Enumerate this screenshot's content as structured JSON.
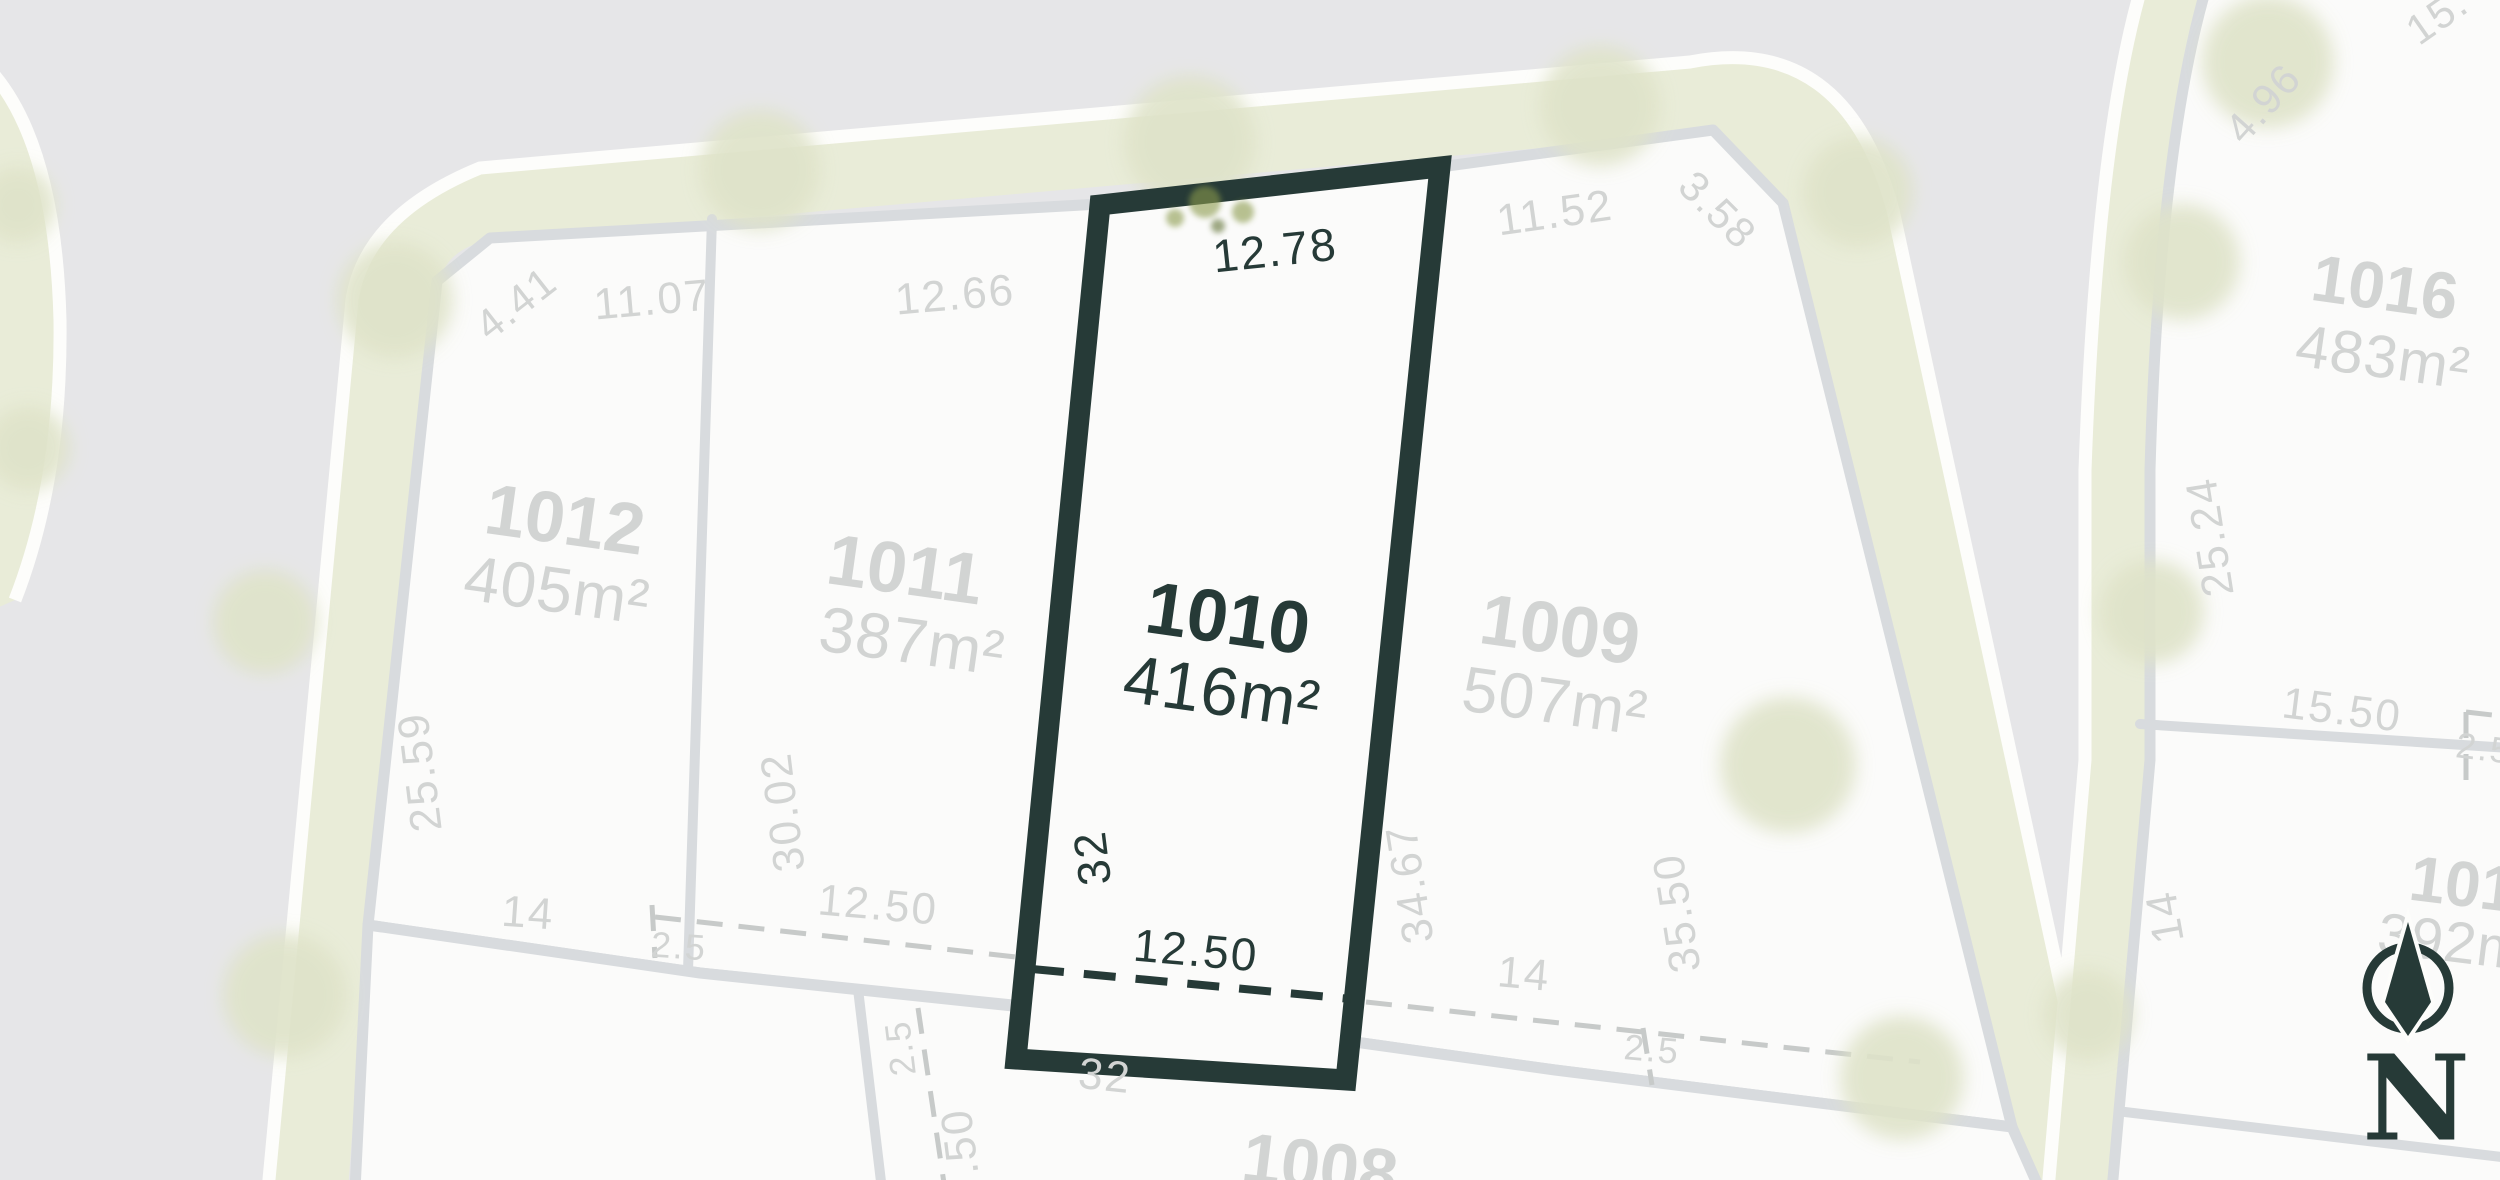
{
  "map": {
    "title": "Estate subdivision plan",
    "compass": {
      "label": "N"
    },
    "selected_lot": {
      "id": "l1010",
      "number": "1010",
      "area": "416m²"
    },
    "lots": [
      {
        "id": "l1012",
        "number": "1012",
        "area": "405m²",
        "selected": false
      },
      {
        "id": "l1011",
        "number": "1011",
        "area": "387m²",
        "selected": false
      },
      {
        "id": "l1010",
        "number": "1010",
        "area": "416m²",
        "selected": true
      },
      {
        "id": "l1009",
        "number": "1009",
        "area": "507m²",
        "selected": false
      },
      {
        "id": "l1016",
        "number": "1016",
        "area": "483m²",
        "selected": false
      },
      {
        "id": "l1008",
        "number": "1008",
        "area": "",
        "selected": false
      },
      {
        "id": "l101",
        "number": "101",
        "area": "392m",
        "selected": false
      }
    ],
    "dimensions": [
      {
        "id": "d1",
        "value": "12.78",
        "tone": "dark"
      },
      {
        "id": "d2",
        "value": "12.66",
        "tone": "gray"
      },
      {
        "id": "d3",
        "value": "11.07",
        "tone": "gray"
      },
      {
        "id": "d4",
        "value": "4.41",
        "tone": "gray"
      },
      {
        "id": "d5",
        "value": "11.52",
        "tone": "gray"
      },
      {
        "id": "d6",
        "value": "3.58",
        "tone": "gray"
      },
      {
        "id": "d7",
        "value": "25.59",
        "tone": "gray"
      },
      {
        "id": "d8",
        "value": "30.02",
        "tone": "gray"
      },
      {
        "id": "d9",
        "value": "32",
        "tone": "dark"
      },
      {
        "id": "d10",
        "value": "34.67",
        "tone": "gray"
      },
      {
        "id": "d11",
        "value": "35.50",
        "tone": "gray"
      },
      {
        "id": "d12",
        "value": "14",
        "tone": "gray"
      },
      {
        "id": "d13",
        "value": "2.5",
        "tone": "gray"
      },
      {
        "id": "d14",
        "value": "12.50",
        "tone": "gray"
      },
      {
        "id": "d15",
        "value": "12.50",
        "tone": "dark"
      },
      {
        "id": "d16",
        "value": "14",
        "tone": "gray"
      },
      {
        "id": "d17",
        "value": "2.5",
        "tone": "gray"
      },
      {
        "id": "d18",
        "value": "2.5",
        "tone": "gray"
      },
      {
        "id": "d19",
        "value": ".50",
        "tone": "gray"
      },
      {
        "id": "d20",
        "value": "32",
        "tone": "gray"
      },
      {
        "id": "d21",
        "value": "4.96",
        "tone": "gray"
      },
      {
        "id": "d22",
        "value": "15.",
        "tone": "gray"
      },
      {
        "id": "d23",
        "value": "25.24",
        "tone": "gray"
      },
      {
        "id": "d24",
        "value": "15.50",
        "tone": "gray"
      },
      {
        "id": "d25",
        "value": "2.5",
        "tone": "gray"
      },
      {
        "id": "d26",
        "value": "14",
        "tone": "gray"
      }
    ],
    "colors": {
      "road": "#e6e6e8",
      "lot": "#fbfbfa",
      "verge": "#e9ecd8",
      "curb": "#fdfdfb",
      "boundary": "#d8dbde",
      "dash_gray": "#c7cac9",
      "text_gray": "#d2d4d3",
      "selected_dark": "#263a37",
      "tree_pale": "#dfe3c9",
      "tree_green": "#8a9a4c"
    }
  }
}
